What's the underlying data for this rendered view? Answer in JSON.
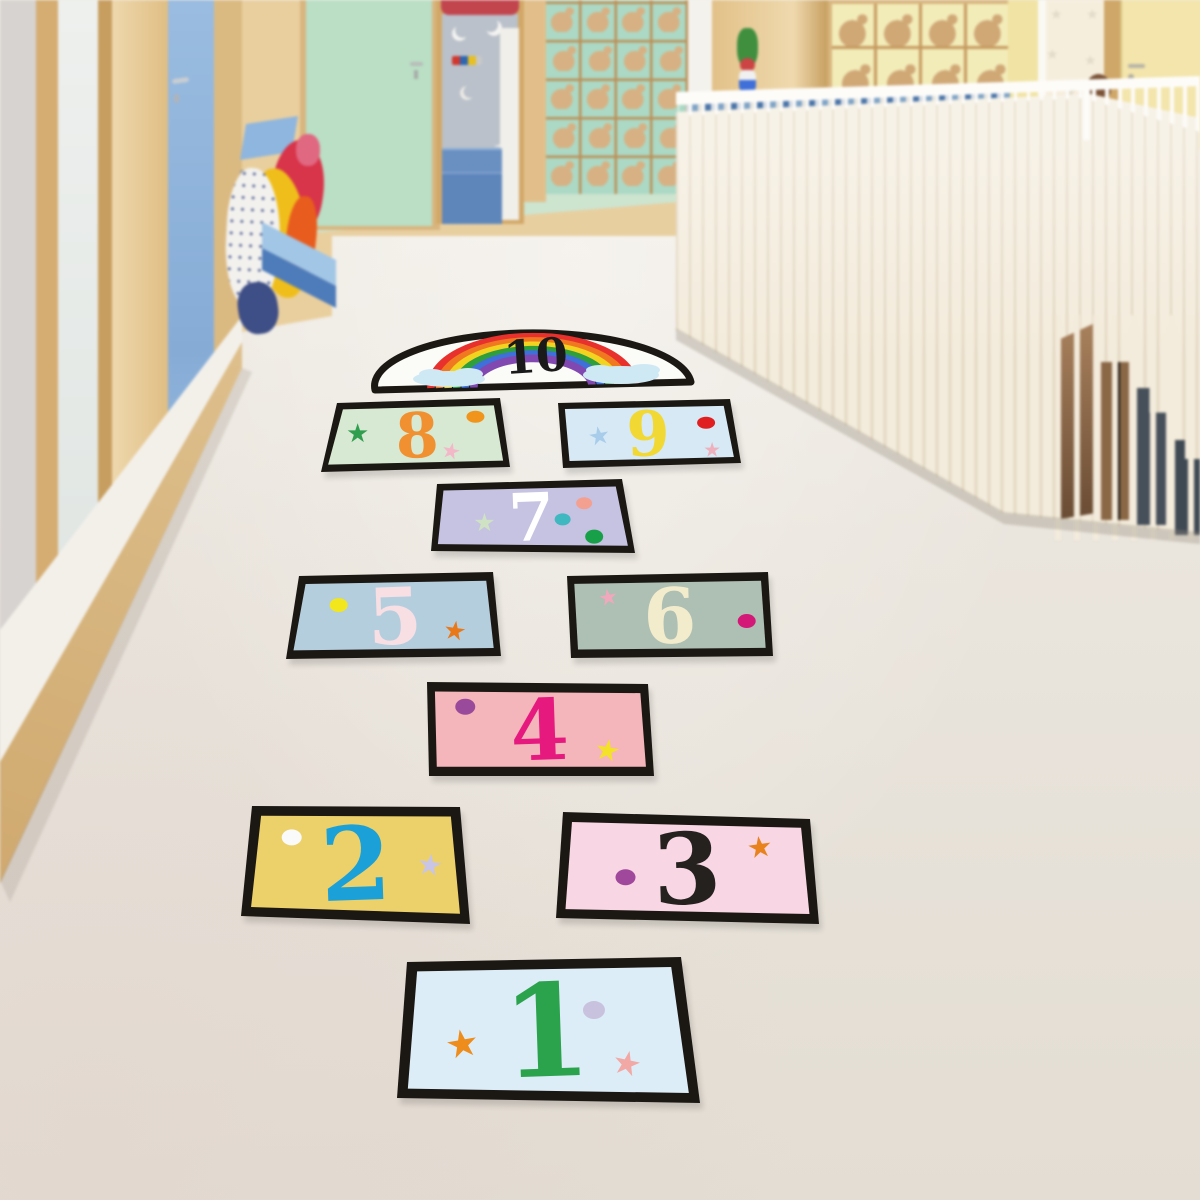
{
  "palette": {
    "floor-light": "#f1ede6",
    "floor-mid": "#eae5dd",
    "floor-dark": "#e3ddd3",
    "wood": "#e8cfa0",
    "wood-dark": "#c89e60",
    "wood-light": "#eed8ad",
    "wood-frame": "#d5ad72",
    "gray-wall": "#d7d3d0",
    "white-wall": "#f3f0ea",
    "blue-door": "#8fb4dc",
    "mint-door": "#badfc5",
    "mint-wall": "#cde4cf",
    "curtain": "#bac1ca",
    "canopy-red": "#c2454e",
    "steps-blue": "#5e86bb",
    "mint-tiles": "#abd9c5",
    "cream-tiles": "#f2ecb9",
    "animal-tan": "#d7b183",
    "grid-wood": "#bb9058",
    "white-pillar": "#f4f2ed",
    "yellow-wall": "#f1e3a3",
    "yellow-door": "#f3e5ab",
    "star-door": "#f6eedd",
    "star-decal": "#e2dbc9",
    "railing-cream": "#f3ebdb",
    "railing-slat": "#e2d6be",
    "handrail": "#fdfcf9",
    "mosaic-blue": "#4a74a8",
    "stair-dark": "#46505a",
    "stair-brown": "#96714d",
    "bench-top": "#a2c6e6",
    "bench-front": "#4e7cba",
    "shelf-blue": "#8fb6de",
    "jacket-white": "#f2f1ee",
    "jacket-yellow": "#f0be1a",
    "jacket-red": "#d8344a",
    "jacket-orange": "#e85c1e",
    "jacket-navy": "#3e4e86",
    "jacket-pink": "#e06880",
    "head-brown": "#7a5236",
    "sticker-border": "#1b1712"
  },
  "hopscotch": {
    "sticker_border_color": "#1b1712",
    "tiles": [
      {
        "id": "1",
        "number": "1",
        "face": "#dcedf8",
        "number_color": "#2aa34c",
        "decorations": [
          {
            "shape": "star",
            "color": "#ee8c1c",
            "u": 0.21,
            "v": 0.6,
            "size": 38,
            "rot": -10
          },
          {
            "shape": "dot",
            "color": "#c9c2de",
            "u": 0.67,
            "v": 0.36,
            "rx": 11,
            "ry": 9
          },
          {
            "shape": "star",
            "color": "#f2a8a4",
            "u": 0.77,
            "v": 0.73,
            "size": 33,
            "rot": 12
          }
        ]
      },
      {
        "id": "2",
        "number": "2",
        "face": "#ecd06a",
        "number_color": "#1ba0d8",
        "decorations": [
          {
            "shape": "dot",
            "color": "#fafafa",
            "u": 0.2,
            "v": 0.28,
            "rx": 10,
            "ry": 8
          },
          {
            "shape": "star",
            "color": "#c9c5e6",
            "u": 0.84,
            "v": 0.5,
            "size": 29,
            "rot": 8
          }
        ]
      },
      {
        "id": "3",
        "number": "3",
        "face": "#f8d6e4",
        "number_color": "#25211f",
        "decorations": [
          {
            "shape": "dot",
            "color": "#a0489c",
            "u": 0.26,
            "v": 0.6,
            "rx": 10,
            "ry": 8
          },
          {
            "shape": "star",
            "color": "#e8821c",
            "u": 0.79,
            "v": 0.28,
            "size": 29,
            "rot": -8
          }
        ]
      },
      {
        "id": "4",
        "number": "4",
        "face": "#f4b6ba",
        "number_color": "#e6197f",
        "decorations": [
          {
            "shape": "dot",
            "color": "#9a4a9a",
            "u": 0.17,
            "v": 0.26,
            "rx": 10,
            "ry": 8
          },
          {
            "shape": "star",
            "color": "#f4e228",
            "u": 0.8,
            "v": 0.72,
            "size": 29,
            "rot": 10
          }
        ]
      },
      {
        "id": "5",
        "number": "5",
        "face": "#b5cede",
        "number_color": "#f7dfe4",
        "decorations": [
          {
            "shape": "dot",
            "color": "#f2e61c",
            "u": 0.22,
            "v": 0.36,
            "rx": 9,
            "ry": 7
          },
          {
            "shape": "star",
            "color": "#e87818",
            "u": 0.79,
            "v": 0.7,
            "size": 26,
            "rot": 8
          }
        ]
      },
      {
        "id": "6",
        "number": "6",
        "face": "#aebfb3",
        "number_color": "#f2eccd",
        "decorations": [
          {
            "shape": "star",
            "color": "#f2a8bc",
            "u": 0.2,
            "v": 0.28,
            "size": 22,
            "rot": -10
          },
          {
            "shape": "dot",
            "color": "#d41878",
            "u": 0.88,
            "v": 0.58,
            "rx": 9,
            "ry": 7
          }
        ]
      },
      {
        "id": "7",
        "number": "7",
        "face": "#c6c2e2",
        "number_color": "#ffffff",
        "decorations": [
          {
            "shape": "star",
            "color": "#cfe2c4",
            "u": 0.26,
            "v": 0.58,
            "size": 25,
            "rot": 0
          },
          {
            "shape": "dot",
            "color": "#3fb8c0",
            "u": 0.66,
            "v": 0.54,
            "rx": 8,
            "ry": 6
          },
          {
            "shape": "dot",
            "color": "#f4a090",
            "u": 0.78,
            "v": 0.32,
            "rx": 8,
            "ry": 6
          },
          {
            "shape": "dot",
            "color": "#18a048",
            "u": 0.81,
            "v": 0.78,
            "rx": 9,
            "ry": 7
          }
        ]
      },
      {
        "id": "8",
        "number": "8",
        "face": "#d7e9d2",
        "number_color": "#f09030",
        "decorations": [
          {
            "shape": "star",
            "color": "#2f9e4f",
            "u": 0.16,
            "v": 0.46,
            "size": 26,
            "rot": 0
          },
          {
            "shape": "dot",
            "color": "#f0941c",
            "u": 0.84,
            "v": 0.26,
            "rx": 9,
            "ry": 6
          },
          {
            "shape": "star",
            "color": "#f2b8c8",
            "u": 0.69,
            "v": 0.76,
            "size": 22,
            "rot": 12
          }
        ]
      },
      {
        "id": "9",
        "number": "9",
        "face": "#d7e9f5",
        "number_color": "#f2d832",
        "decorations": [
          {
            "shape": "star",
            "color": "#a8cdea",
            "u": 0.22,
            "v": 0.52,
            "size": 25,
            "rot": -10
          },
          {
            "shape": "dot",
            "color": "#e02020",
            "u": 0.84,
            "v": 0.36,
            "rx": 9,
            "ry": 6
          },
          {
            "shape": "star",
            "color": "#eeb0bc",
            "u": 0.85,
            "v": 0.78,
            "size": 20,
            "rot": 0
          }
        ]
      },
      {
        "id": "10",
        "number": "10",
        "face": "#fbfbf8",
        "number_color": "#1a1a1a",
        "rainbow_colors": [
          "#e8302c",
          "#f07820",
          "#f2d420",
          "#2f9e3c",
          "#3f6fd8",
          "#8048b0"
        ],
        "cloud_color": "#cfe9f4",
        "decorations": []
      }
    ]
  }
}
